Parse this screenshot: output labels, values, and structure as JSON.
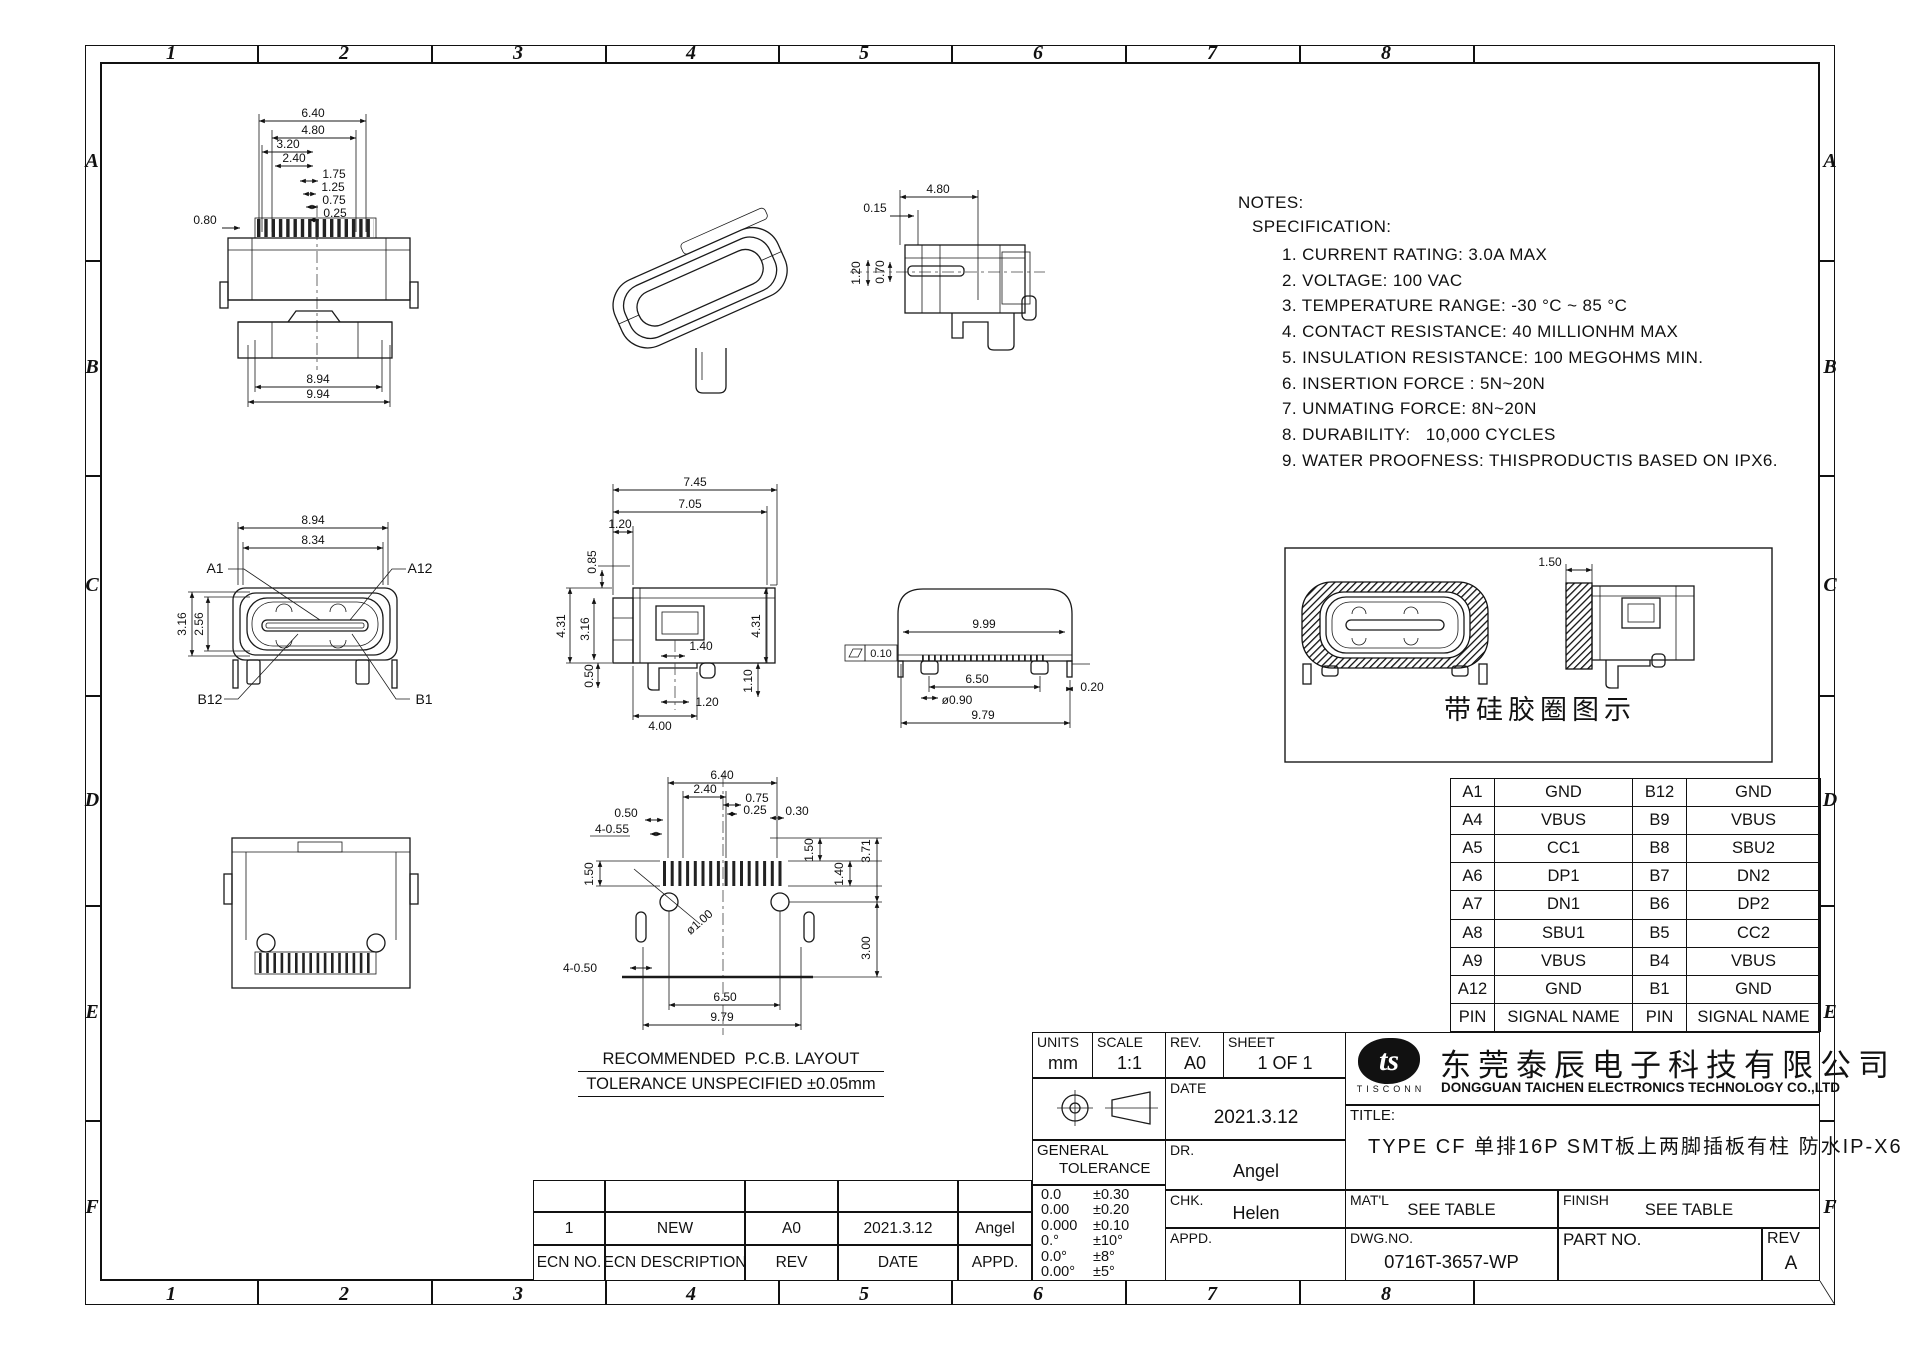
{
  "grid": {
    "cols": [
      "1",
      "2",
      "3",
      "4",
      "5",
      "6",
      "7",
      "8"
    ],
    "rows": [
      "A",
      "B",
      "C",
      "D",
      "E",
      "F"
    ]
  },
  "notes": {
    "title": "NOTES:",
    "subtitle": "SPECIFICATION:",
    "items": [
      "1. CURRENT RATING: 3.0A MAX",
      "2. VOLTAGE: 100 VAC",
      "3. TEMPERATURE RANGE: -30 °C ~ 85 °C",
      "4. CONTACT RESISTANCE: 40 MILLIONHM MAX",
      "5. INSULATION RESISTANCE: 100 MEGOHMS MIN.",
      "6. INSERTION FORCE : 5N~20N",
      "7. UNMATING FORCE: 8N~20N",
      "8. DURABILITY:   10,000 CYCLES",
      "9. WATER PROOFNESS: THISPRODUCTIS BASED ON IPX6."
    ]
  },
  "views": {
    "top_view": {
      "d1": "6.40",
      "d2": "4.80",
      "d3": "3.20",
      "d4": "2.40",
      "d5": "1.75",
      "d6": "1.25",
      "d7": "0.75",
      "d8": "0.25",
      "d9": "0.80",
      "d10": "8.94",
      "d11": "9.94"
    },
    "section_view": {
      "d1": "4.80",
      "d2": "0.15",
      "d3": "1.20",
      "d4": "0.70"
    },
    "front_view": {
      "d1": "8.94",
      "d2": "8.34",
      "d3": "3.16",
      "d4": "2.56",
      "a1": "A1",
      "a12": "A12",
      "b12": "B12",
      "b1": "B1"
    },
    "side_view": {
      "d1": "7.45",
      "d2": "7.05",
      "d3": "1.20",
      "d4": "0.85",
      "d5": "4.31",
      "d6": "3.16",
      "d7": "0.50",
      "d8": "1.40",
      "d9": "1.20",
      "d10": "4.00",
      "d11": "4.31",
      "d12": "1.10"
    },
    "rear_view": {
      "d1": "9.99",
      "d2": "6.50",
      "d3": "ø0.90",
      "d4": "0.20",
      "d5": "9.79",
      "d6": "0.10"
    },
    "silicone_view": {
      "d1": "1.50",
      "caption": "带硅胶圈图示"
    },
    "pcb_layout": {
      "d1": "6.40",
      "d2": "2.40",
      "d3": "0.75",
      "d4": "0.25",
      "d5": "0.50",
      "d6": "4-0.55",
      "d7": "0.30",
      "d8": "1.50",
      "d9": "ø1.00",
      "d10": "4-0.50",
      "d11": "6.50",
      "d12": "9.79",
      "d13": "1.50",
      "d14": "1.40",
      "d15": "3.71",
      "d16": "3.00",
      "caption1": "RECOMMENDED  P.C.B. LAYOUT",
      "caption2": "TOLERANCE UNSPECIFIED ±0.05mm"
    }
  },
  "pin_table": {
    "rows": [
      [
        "A1",
        "GND",
        "B12",
        "GND"
      ],
      [
        "A4",
        "VBUS",
        "B9",
        "VBUS"
      ],
      [
        "A5",
        "CC1",
        "B8",
        "SBU2"
      ],
      [
        "A6",
        "DP1",
        "B7",
        "DN2"
      ],
      [
        "A7",
        "DN1",
        "B6",
        "DP2"
      ],
      [
        "A8",
        "SBU1",
        "B5",
        "CC2"
      ],
      [
        "A9",
        "VBUS",
        "B4",
        "VBUS"
      ],
      [
        "A12",
        "GND",
        "B1",
        "GND"
      ],
      [
        "PIN",
        "SIGNAL NAME",
        "PIN",
        "SIGNAL NAME"
      ]
    ]
  },
  "title_block": {
    "units_label": "UNITS",
    "units_value": "mm",
    "scale_label": "SCALE",
    "scale_value": "1:1",
    "rev_label": "REV.",
    "rev_value": "A0",
    "sheet_label": "SHEET",
    "sheet_value": "1 OF 1",
    "date_label": "DATE",
    "date_value": "2021.3.12",
    "dr_label": "DR.",
    "dr_value": "Angel",
    "chk_label": "CHK.",
    "chk_value": "Helen",
    "appd_label": "APPD.",
    "appd_value": "",
    "gt_line1": "GENERAL",
    "gt_line2": "TOLERANCE",
    "tolerances": [
      [
        "0.0",
        "±0.30"
      ],
      [
        "0.00",
        "±0.20"
      ],
      [
        "0.000",
        "±0.10"
      ],
      [
        "0.°",
        "±10°"
      ],
      [
        "0.0°",
        "±8°"
      ],
      [
        "0.00°",
        "±5°"
      ]
    ],
    "company_cn": "东莞泰辰电子科技有限公司",
    "company_en": "DONGGUAN TAICHEN ELECTRONICS TECHNOLOGY CO.,LTD",
    "logo_text": "ts",
    "logo_sub": "TISCONN",
    "title_label": "TITLE:",
    "title_value": "TYPE CF 单排16P SMT板上两脚插板有柱 防水IP-X6",
    "matl_label": "MAT'L",
    "matl_value": "SEE TABLE",
    "finish_label": "FINISH",
    "finish_value": "SEE TABLE",
    "dwgno_label": "DWG.NO.",
    "dwgno_value": "0716T-3657-WP",
    "partno_label": "PART NO.",
    "partno_value": "",
    "rev2_label": "REV",
    "rev2_value": "A"
  },
  "ecn_table": {
    "data_row": [
      "1",
      "NEW",
      "A0",
      "2021.3.12",
      "Angel"
    ],
    "header_row": [
      "ECN NO.",
      "ECN DESCRIPTION",
      "REV",
      "DATE",
      "APPD."
    ]
  }
}
